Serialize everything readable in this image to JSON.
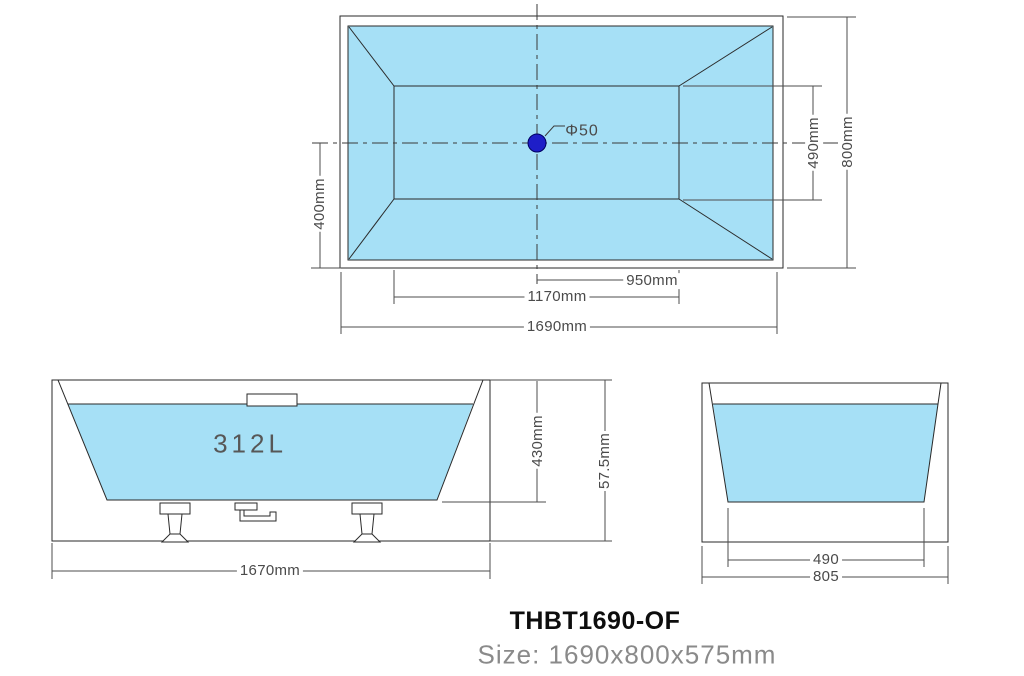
{
  "drawing": {
    "type": "bathtub technical drawing, 3 orthographic views",
    "colors": {
      "water_fill": "#A6E0F6",
      "drain_fill": "#1E1EC8",
      "geometry_line": "#2A2A2A",
      "dimension_line": "#4D4D4D",
      "dimension_text": "#4A4A4A",
      "subtitle_text": "#8A8A8A"
    }
  },
  "top_view": {
    "drain_label": "Φ50",
    "dim_center_to_edge": "400mm",
    "dim_inner_width": "490mm",
    "dim_overall_width": "800mm",
    "dim_drain_to_end": "950mm",
    "dim_inner_length": "1170mm",
    "dim_overall_length": "1690mm"
  },
  "side_view": {
    "capacity": "312L",
    "dim_depth": "430mm",
    "dim_overall_height": "57.5mm",
    "dim_base_length": "1670mm"
  },
  "end_view": {
    "dim_inner_width": "490",
    "dim_overall_width": "805"
  },
  "footer": {
    "model": "THBT1690-OF",
    "size": "Size: 1690x800x575mm"
  }
}
